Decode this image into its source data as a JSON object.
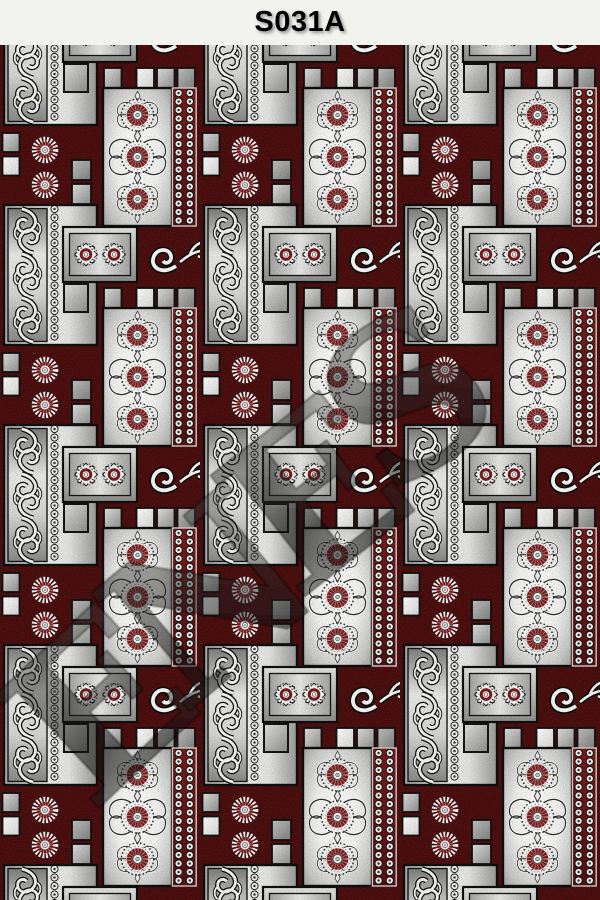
{
  "header": {
    "title": "S031A"
  },
  "watermark": {
    "letters": [
      "E",
      "N",
      "E",
      "S"
    ]
  },
  "palette": {
    "titlebar_bg": "#f2f2ef",
    "title_color": "#000000",
    "carpet_maroon": "#5e1313",
    "panel_silver": "#ededeb",
    "panel_gray": "#a9a9a7",
    "ornament_white": "#f4f4f2",
    "flower_accent_red": "#7b1f1f",
    "outline_black": "#101010"
  },
  "pattern": {
    "motifs": [
      "sunburst-flower-panel",
      "bead-chain-border",
      "acanthus-scroll-strip",
      "double-medallion-panel",
      "scroll-flourish",
      "rosette-pair",
      "accent-squares"
    ]
  }
}
